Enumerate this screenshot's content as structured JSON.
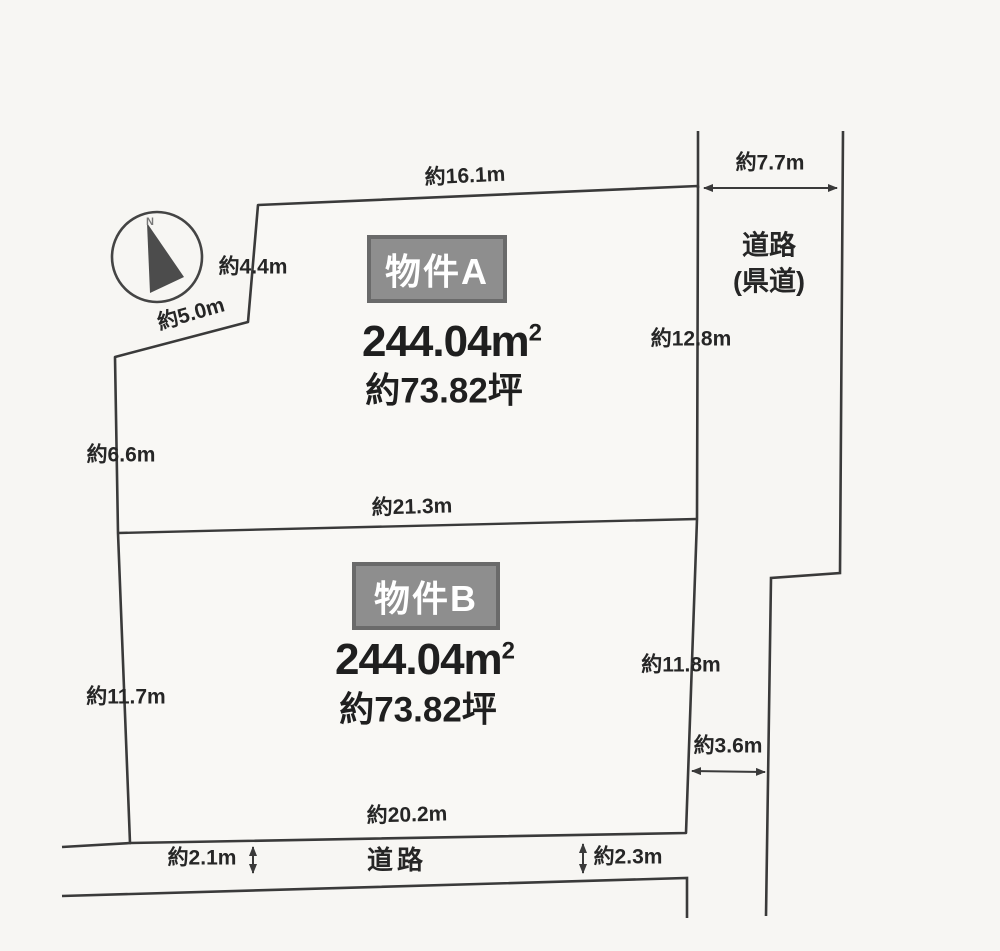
{
  "compass": {
    "north": "N"
  },
  "properties": {
    "a": {
      "badge": "物件A",
      "area_value": "244.04",
      "area_unit": "m",
      "area_sup": "2",
      "tsubo": "約73.82坪"
    },
    "b": {
      "badge": "物件B",
      "area_value": "244.04",
      "area_unit": "m",
      "area_sup": "2",
      "tsubo": "約73.82坪"
    }
  },
  "roads": {
    "right_name": "道路",
    "right_type": "(県道)",
    "bottom_name": "道路"
  },
  "dims": {
    "a_top": "約16.1m",
    "road_width_top": "約7.7m",
    "a_left_upper": "約4.4m",
    "a_left_diagonal": "約5.0m",
    "a_right": "約12.8m",
    "a_left": "約6.6m",
    "divider": "約21.3m",
    "b_left": "約11.7m",
    "b_right": "約11.8m",
    "road_width_mid": "約3.6m",
    "b_bottom": "約20.2m",
    "road_width_bottom_left": "約2.1m",
    "road_width_bottom_right": "約2.3m"
  },
  "colors": {
    "line": "#3a3a3a",
    "paper": "#f7f6f3",
    "badge_bg": "#8e8e8e",
    "badge_border": "#6a6a6a",
    "text": "#262626"
  }
}
